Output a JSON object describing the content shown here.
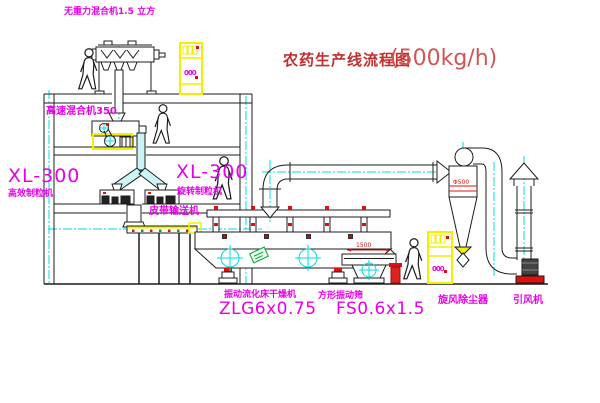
{
  "title": {
    "text": "农药生产线流程图",
    "capacity": "(500kg/h)"
  },
  "labels": {
    "gravity_mixer": "无重力混合机1.5 立方",
    "high_speed_mixer": "高速混合机350",
    "xl300_left": "XL-300",
    "granulator_left_sub": "高效制粒机",
    "xl300_center": "XL-300",
    "granulator_center_sub": "旋转制粒机",
    "belt_conveyor": "皮带输送机",
    "fluid_bed_dryer": "振动流化床干燥机",
    "fluid_bed_dryer_model": "ZLG6x0.75",
    "square_sieve": "方形振动筛",
    "square_sieve_model": "FS0.6x1.5",
    "cyclone_dust_collector": "旋风除尘器",
    "induced_draft_fan": "引风机"
  },
  "annotations": {
    "cyclone_dimension": "Φ500",
    "sieve_dimension": "1500",
    "cabinet1_display": "000",
    "cabinet2_display": "000"
  },
  "colors": {
    "label_magenta": "#e800e8",
    "title_red": "#c22e2e",
    "line_black": "#1c1c1c",
    "flow_cyan": "#00dede",
    "equipment_yellow": "#f0f000",
    "detail_red": "#e01010",
    "logo_green": "#00a33c"
  }
}
